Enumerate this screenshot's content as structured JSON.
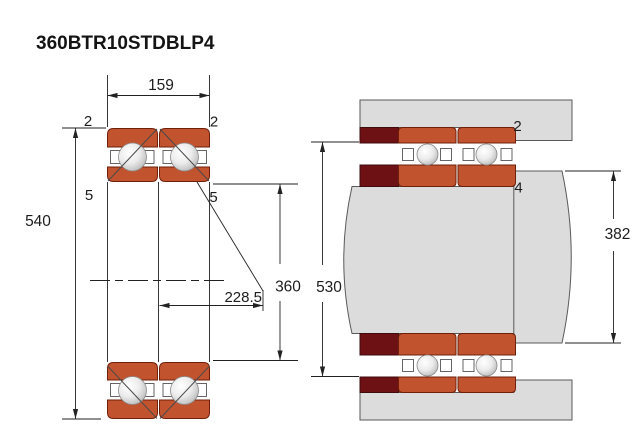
{
  "title": "360BTR10STDBLP4",
  "colors": {
    "bearing_ring_orange": "#c2532f",
    "spacer_maroon": "#6d1115",
    "steel_gray": "#dcdcdc",
    "line_black": "#222222"
  },
  "left_view": {
    "dim_width": "159",
    "dim_outer_diameter": "540",
    "dim_bore": "360",
    "dim_load_center": "228.5",
    "label_top_left": "2",
    "label_top_right": "2",
    "label_mid_left": "5",
    "label_mid_right": "5"
  },
  "right_view": {
    "dim_housing_abutment": "530",
    "dim_shaft_shoulder": "382",
    "label_outer": "2",
    "label_inner": "4"
  }
}
